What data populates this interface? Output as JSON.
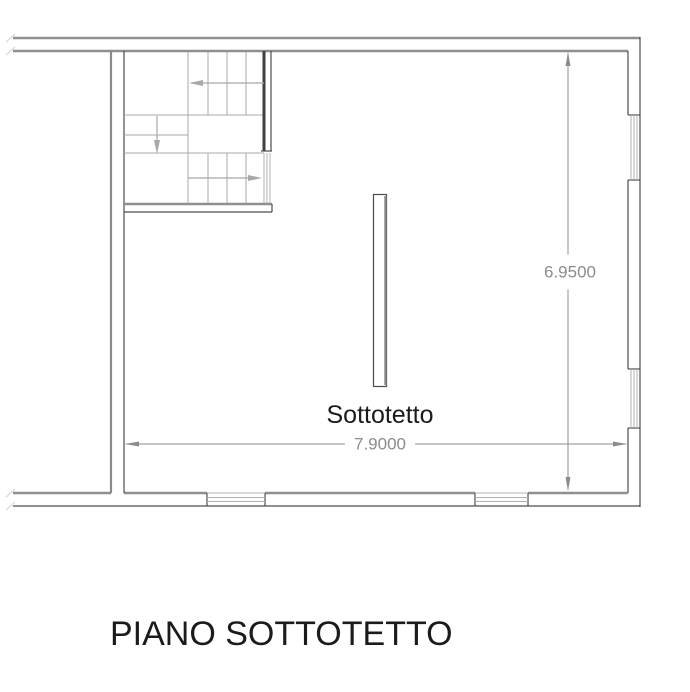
{
  "drawing": {
    "plan_title": "PIANO SOTTOTETTO",
    "room_label": "Sottotetto",
    "dimensions": {
      "width_label": "7.9000",
      "height_label": "6.9500"
    },
    "stairs": {
      "direction_arrows": [
        "left",
        "down",
        "right"
      ]
    },
    "windows": {
      "right_wall_count": 2,
      "bottom_wall_count": 2
    }
  },
  "colors": {
    "wall-thick": "#8f8f8f",
    "wall-mid": "#8a8a8a",
    "wall-thin": "#4d4d4d",
    "wall-dark": "#3f3f3f",
    "stair-line": "#a8a8a8",
    "window-line": "#b2b2b2",
    "dim-line": "#8c8c8c",
    "label-text": "#1b1b1b",
    "break-mark": "#d9d9d9"
  }
}
